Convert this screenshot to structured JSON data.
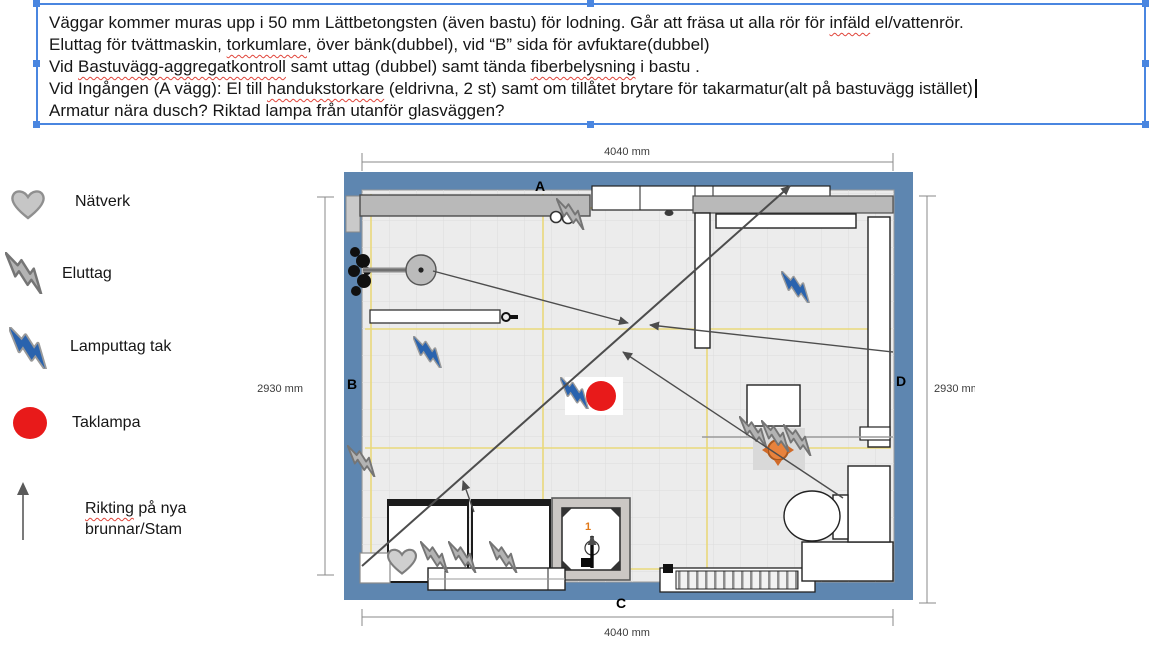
{
  "note_box": {
    "lines": [
      {
        "segments": [
          {
            "t": "Väggar kommer muras upp i 50 mm Lättbetongsten (även bastu) för lodning. Går att fräsa ut alla rör för "
          },
          {
            "t": "infäld",
            "sq": true
          },
          {
            "t": " el/vattenrör."
          }
        ]
      },
      {
        "segments": [
          {
            "t": "Eluttag för tvättmaskin, "
          },
          {
            "t": "torkumlare",
            "sq": true
          },
          {
            "t": ", över bänk(dubbel), vid “B” sida för avfuktare(dubbel)"
          }
        ]
      },
      {
        "segments": [
          {
            "t": "Vid "
          },
          {
            "t": "Bastuvägg-aggregatkontroll",
            "sq": true
          },
          {
            "t": " samt uttag (dubbel) samt tända "
          },
          {
            "t": "fiberbelysning",
            "sq": true
          },
          {
            "t": " i bastu ."
          }
        ]
      },
      {
        "segments": [
          {
            "t": "Vid Ingången (A vägg): El till "
          },
          {
            "t": "handukstorkare",
            "sq": true
          },
          {
            "t": " (eldrivna, 2 st) samt om tillåtet brytare för takarmatur(alt på bastuvägg istället)"
          }
        ],
        "caret": true
      },
      {
        "segments": [
          {
            "t": "Armatur nära dusch? Riktad lampa från utanför glasväggen?"
          }
        ]
      }
    ]
  },
  "legend": {
    "items": [
      {
        "icon": "heart-icon",
        "label": "Nätverk"
      },
      {
        "icon": "lightning-gray-icon",
        "label": "Eluttag"
      },
      {
        "icon": "lightning-blue-icon",
        "label": "Lamputtag tak"
      },
      {
        "icon": "red-circle-icon",
        "label": "Taklampa"
      },
      {
        "icon": "arrow-up-icon",
        "label_line1_word": "Rikting",
        "label_line1_rest": " på nya",
        "label_line2": "brunnar/Stam"
      }
    ]
  },
  "floor_plan": {
    "wall_labels": {
      "top": "A",
      "left": "B",
      "bottom": "C",
      "right": "D"
    },
    "dimensions": {
      "top": "4040 mm",
      "bottom": "4040 mm",
      "left": "2930 mm",
      "right": "2930 mm"
    },
    "drain_label": "1",
    "colors": {
      "wall_blue": "#5e86b0",
      "floor": "#ececec",
      "grid_yellow": "#e9d97b",
      "taklampa_red": "#e81a1a",
      "bolt_blue": "#2a63ae",
      "bolt_gray": "#b3b3b3",
      "heater_orange": "#e8823c",
      "selection_blue": "#4a86e0"
    }
  }
}
